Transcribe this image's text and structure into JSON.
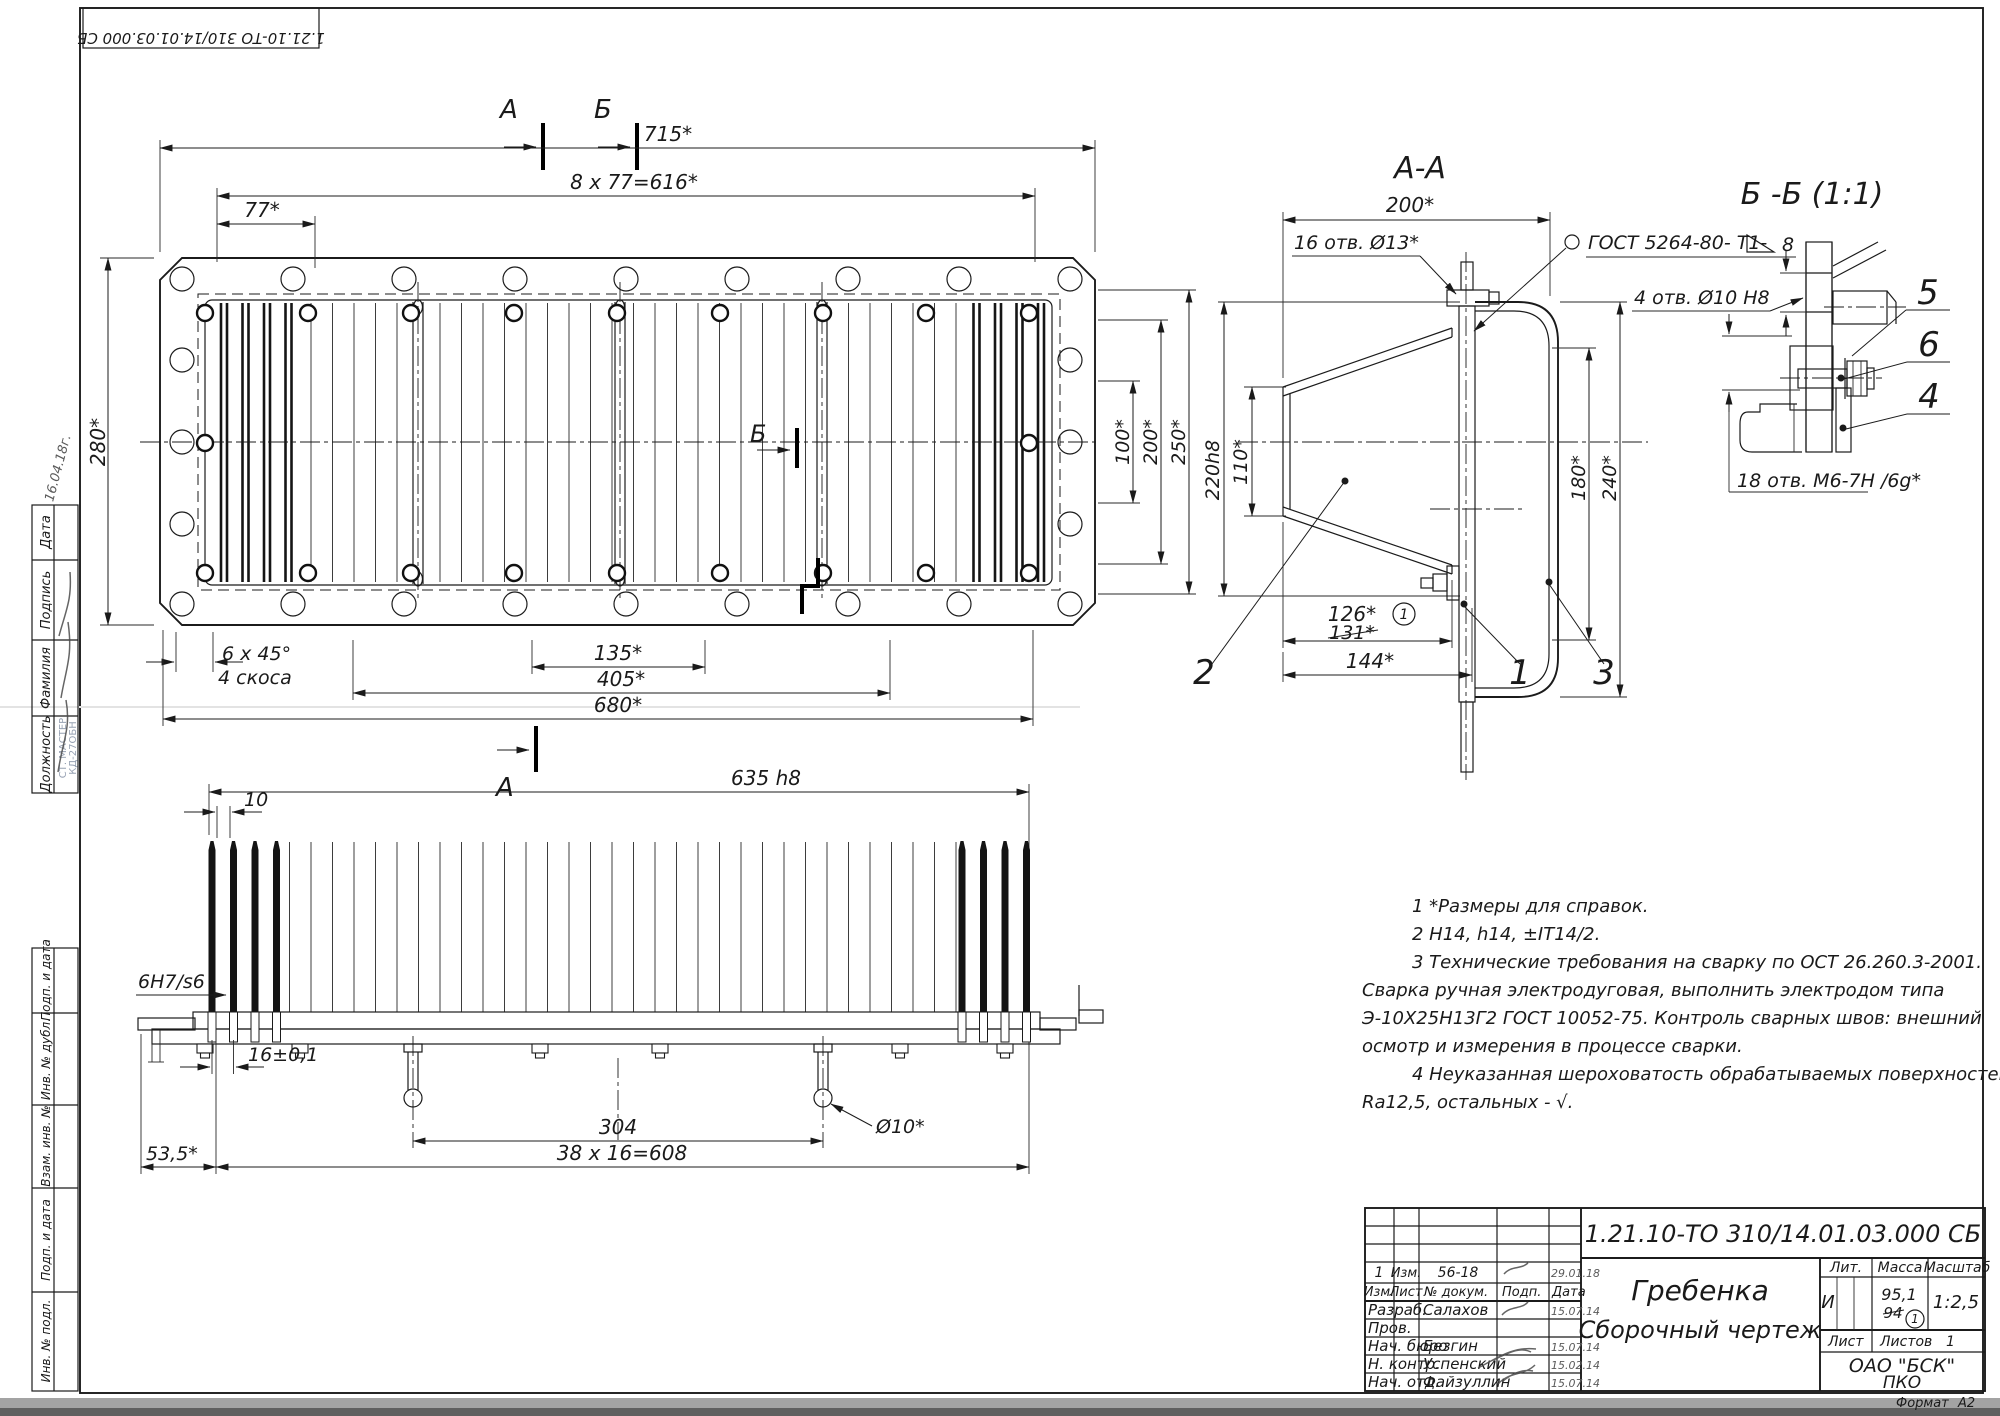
{
  "corner_stamp": {
    "doc_number": "1.21.10-ТО 310/14.01.03.000 СБ"
  },
  "margin_stamps": {
    "block1": [
      "Дата",
      "Подпись",
      "Фамилия",
      "Должность"
    ],
    "block2": [
      "Подп. и дата",
      "Инв. № дубл.",
      "Взам. инв. №",
      "Подп. и дата",
      "Инв. № подл."
    ],
    "faint_stamp_line1": "СТ. МАСТЕР",
    "faint_stamp_line2": "КД-27ОБН",
    "handwriting": "16.04.18г."
  },
  "plan": {
    "dim_715": "715*",
    "dim_616": "8 x 77=616*",
    "dim_77": "77*",
    "dim_280": "280*",
    "dim_100": "100*",
    "dim_200": "200*",
    "dim_250": "250*",
    "chamfer_line1": "6 x 45°",
    "chamfer_line2": "4 скоса",
    "dim_135": "135*",
    "dim_405": "405*",
    "dim_680": "680*",
    "mark_a": "А",
    "mark_b": "Б"
  },
  "section_aa": {
    "title": "А-А",
    "dim_200": "200*",
    "holes_13": "16 отв. Ø13*",
    "weld_note": "ГОСТ 5264-80- Т1-",
    "weld_num": "8",
    "dim_220": "220h8",
    "dim_110": "110*",
    "dim_180": "180*",
    "dim_240": "240*",
    "dim_126": "126*",
    "dim_131_old": "131*",
    "rev_mark": "1",
    "dim_144": "144*",
    "callout_1": "1",
    "callout_2": "2",
    "callout_3": "3"
  },
  "detail_bb": {
    "title": "Б -Б (1:1)",
    "holes_10": "4 отв. Ø10 Н8",
    "holes_m6": "18 отв. М6-7Н /6g*",
    "callout_4": "4",
    "callout_5": "5",
    "callout_6": "6"
  },
  "side_view": {
    "dim_635": "635 h8",
    "dim_10": "10",
    "fit": "6H7/s6",
    "dim_16": "16±0,1",
    "dim_53": "53,5*",
    "dim_304": "304",
    "dim_608": "38 x 16=608",
    "dia_10": "Ø10*",
    "mark_a": "А"
  },
  "notes": {
    "lines": [
      "1 *Размеры для справок.",
      "2  Н14, h14, ±IT14/2.",
      "3  Технические требования на сварку по ОСТ 26.260.3-2001.",
      "Сварка ручная электродуговая, выполнить электродом типа",
      "Э-10Х25Н13Г2  ГОСТ 10052-75. Контроль сварных швов: внешний",
      "осмотр и измерения в процессе сварки.",
      "4  Неуказанная шероховатость обрабатываемых поверхностей",
      "Ra12,5,  остальных - √."
    ]
  },
  "title_block": {
    "doc_number": "1.21.10-ТО 310/14.01.03.000 СБ",
    "part_name": "Гребенка",
    "doc_type": "Сборочный чертеж",
    "org_line1": "ОАО \"БСК\"",
    "org_line2": "ПКО",
    "lit_label": "Лит.",
    "lit_value": "И",
    "mass_label": "Масса",
    "mass_value": "95,1",
    "mass_old": "94",
    "mass_rev": "1",
    "scale_label": "Масштаб",
    "scale_value": "1:2,5",
    "sheet_label": "Лист",
    "sheets_label": "Листов",
    "sheets_value": "1",
    "format_label": "Формат",
    "format_value": "А2",
    "header": {
      "izm": "Изм.",
      "list": "Лист",
      "doc": "№ докум.",
      "sign": "Подп.",
      "date": "Дата"
    },
    "change_row": {
      "num": "1",
      "izm": "Изм.",
      "doc": "56-18",
      "date": "29.01.18"
    },
    "rows": [
      {
        "role": "Разраб.",
        "name": "Салахов",
        "date": "15.07.14"
      },
      {
        "role": "Пров.",
        "name": "",
        "date": ""
      },
      {
        "role": "Нач. бюро",
        "name": "Безгин",
        "date": "15.07.14"
      },
      {
        "role": "Н. контр.",
        "name": "Успенский",
        "date": "15.02.14"
      },
      {
        "role": "Нач. отд.",
        "name": "Файзуллин",
        "date": "15.07.14"
      }
    ]
  }
}
